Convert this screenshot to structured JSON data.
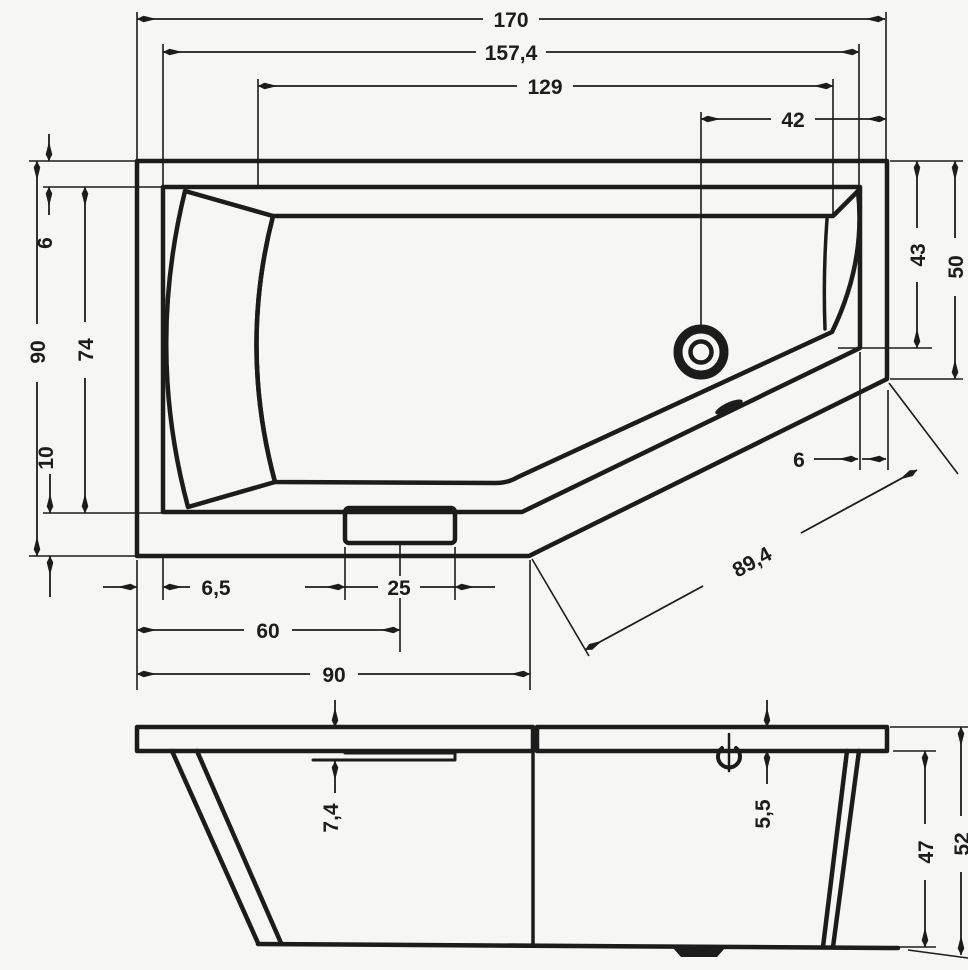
{
  "drawing": {
    "colors": {
      "ink": "#1c1c1c",
      "paper": "#f6f6f5"
    },
    "plan_view": {
      "top_dims": {
        "overall_length": "170",
        "inner_rim_length": "157,4",
        "basin_length": "129",
        "drain_to_end": "42"
      },
      "left_dims": {
        "overall_width": "90",
        "rim_top": "6",
        "basin_width": "74",
        "rim_bottom": "10"
      },
      "right_dims": {
        "basin_end_height": "43",
        "end_width": "50"
      },
      "diagonal_dims": {
        "rim_width": "6",
        "diagonal_edge": "89,4"
      },
      "bottom_dims": {
        "rim_offset": "6,5",
        "plate_width": "25",
        "plate_center": "60",
        "straight_front": "90"
      }
    },
    "side_view": {
      "dims": {
        "recess_depth": "7,4",
        "rim_height": "5,5",
        "body_height": "47",
        "overall_height": "52"
      }
    }
  }
}
